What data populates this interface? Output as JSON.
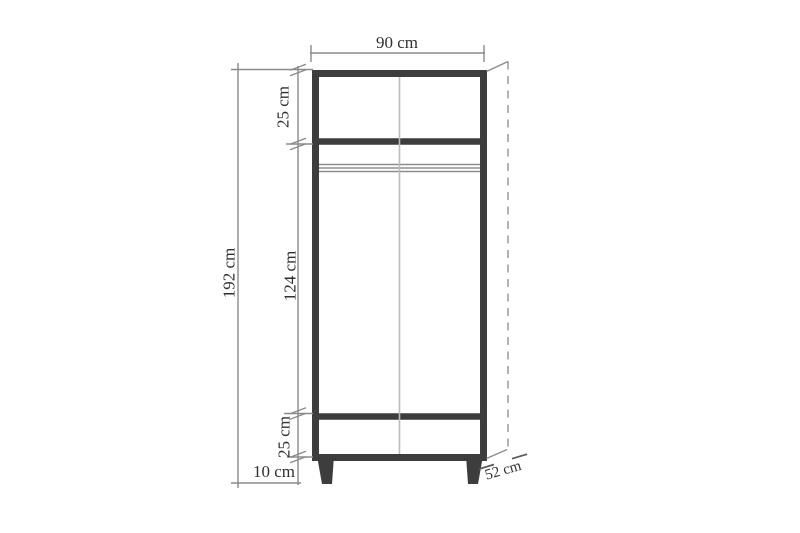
{
  "diagram": {
    "subject": "wardrobe-front-elevation-dimension-drawing",
    "unit": "cm",
    "dims": {
      "width": "90 cm",
      "total_height": "192 cm",
      "top_compartment": "25 cm",
      "door_section": "124 cm",
      "bottom_compartment": "25 cm",
      "leg_height": "10 cm",
      "depth": "52 cm"
    },
    "colors": {
      "background": "#ffffff",
      "outline": "#3d3d3d",
      "dimension_line": "#8a8a8a",
      "door_split_line": "#bcbcbc",
      "hanging_rod": "#8d8d8d",
      "text": "#303030"
    }
  }
}
